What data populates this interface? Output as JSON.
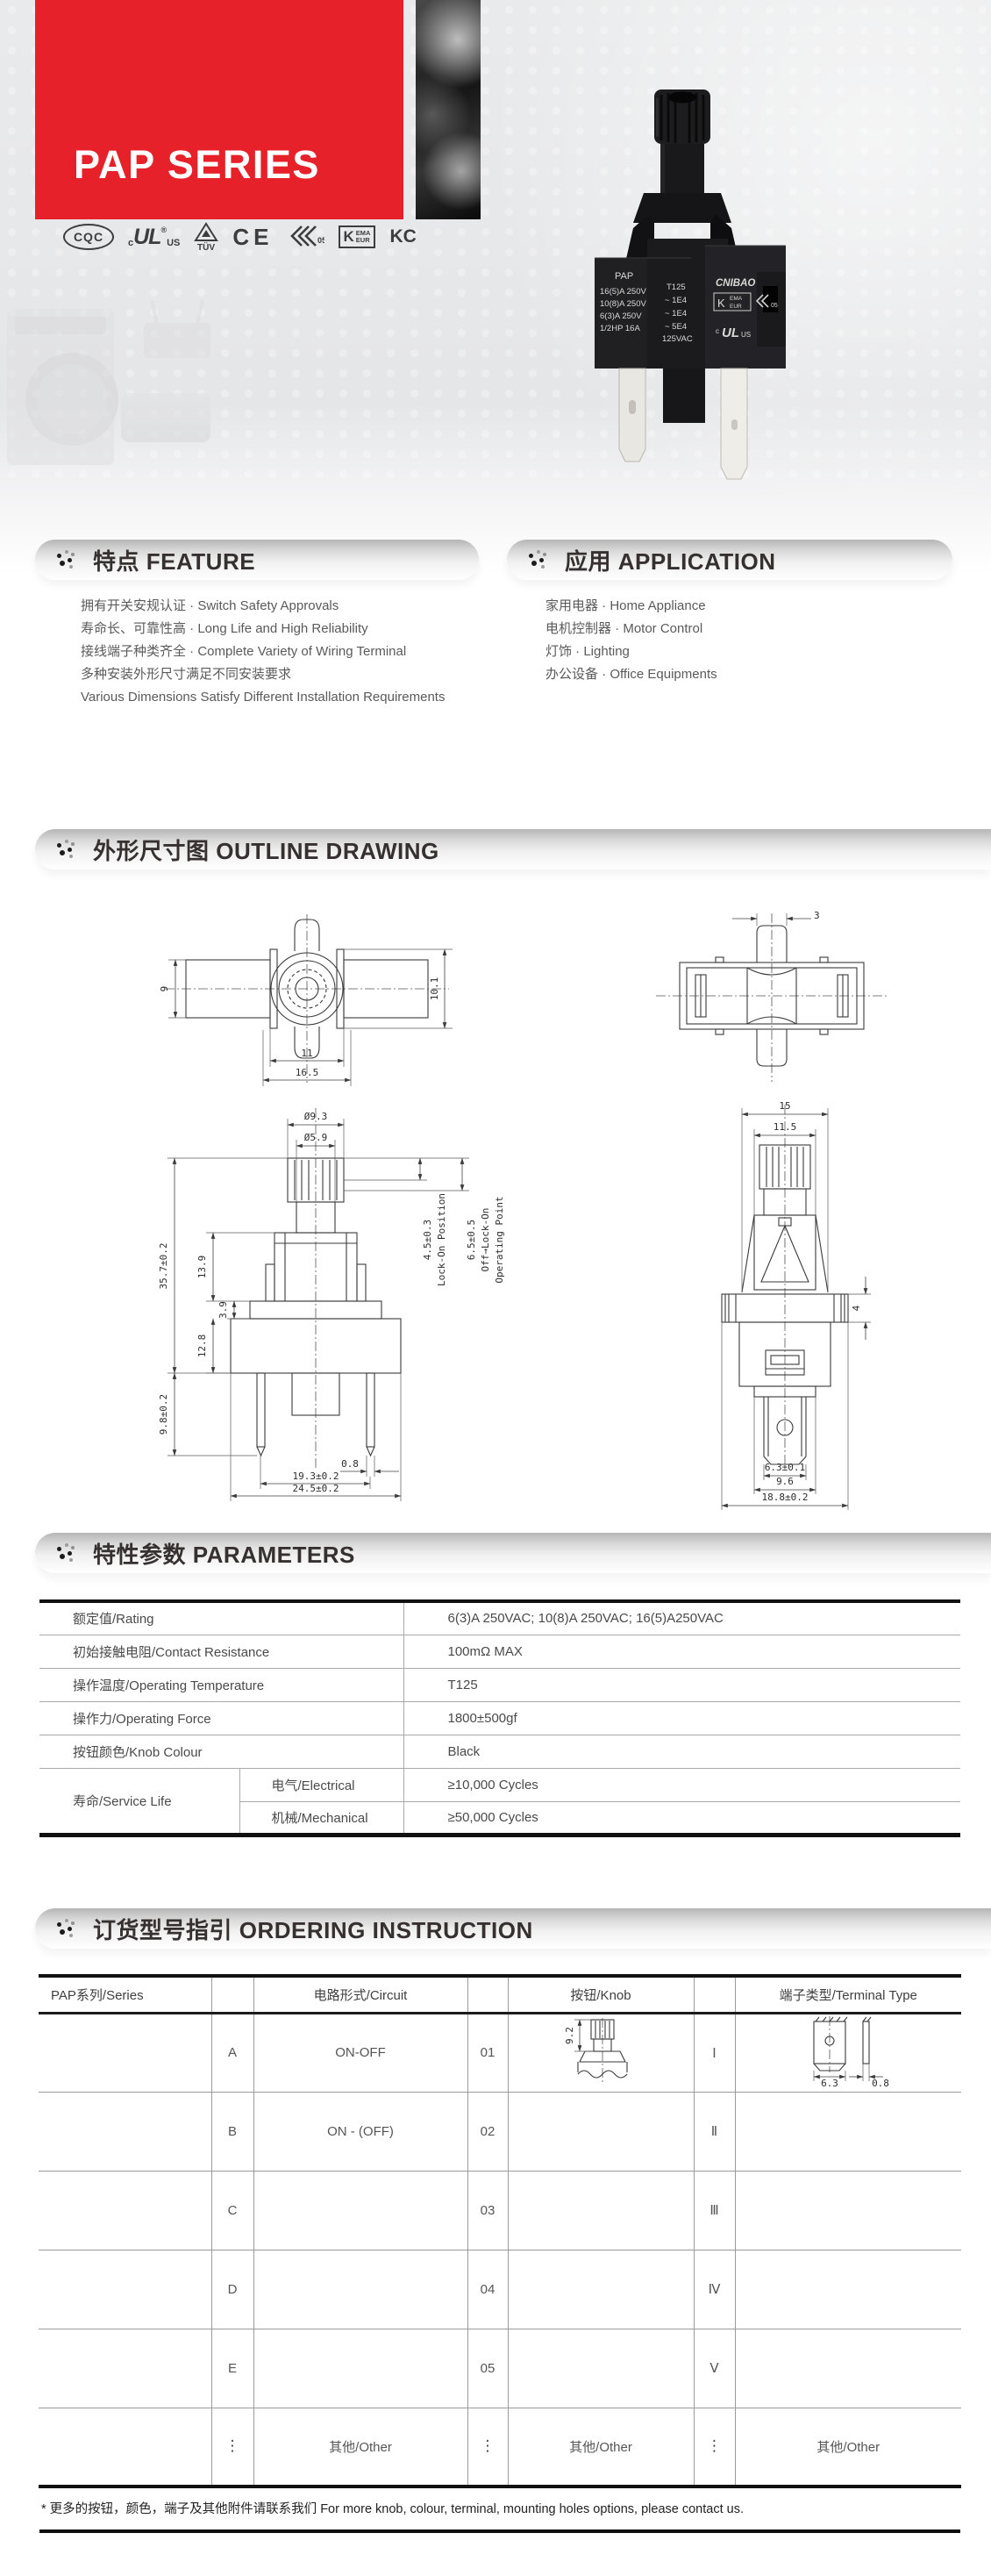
{
  "header": {
    "series_title": "PAP SERIES",
    "banner_color": "#e62129",
    "certs": {
      "cqc": "CQC",
      "ul_c": "c",
      "ul_mark": "UL",
      "ul_reg": "®",
      "ul_us": "US",
      "tuv": "TÜV",
      "ce": "CE",
      "enec_num": "05",
      "kema_k": "K",
      "kema_ema": "EMA",
      "kema_eur": "EUR",
      "kc": "KC"
    },
    "product": {
      "marking_left": [
        "PAP",
        "16(5)A 250V",
        "10(8)A 250V",
        "6(3)A  250V",
        "1/2HP 16A"
      ],
      "marking_mid": [
        "T125",
        "~ 1E4",
        "~ 1E4",
        "~ 5E4",
        "125VAC"
      ],
      "brand": "CNIBAO",
      "kema_k": "K",
      "kema_ema": "EMA",
      "kema_eur": "EUR",
      "enec_num": "05",
      "ul_c": "c",
      "ul_mark": "UL",
      "ul_us": "US"
    }
  },
  "feature": {
    "title": "特点 FEATURE",
    "items": [
      "拥有开关安规认证 · Switch Safety Approvals",
      "寿命长、可靠性高 · Long Life and High Reliability",
      "接线端子种类齐全 · Complete Variety of Wiring Terminal",
      "多种安装外形尺寸满足不同安装要求",
      "Various Dimensions Satisfy Different Installation Requirements"
    ]
  },
  "application": {
    "title": "应用 APPLICATION",
    "items": [
      "家用电器 · Home Appliance",
      "电机控制器 · Motor Control",
      "灯饰 · Lighting",
      "办公设备 · Office Equipments"
    ]
  },
  "outline": {
    "title": "外形尺寸图 OUTLINE DRAWING",
    "top_view": {
      "h_left": "9",
      "h_right": "10.1",
      "w_inner": "11",
      "w_outer": "16.5"
    },
    "bottom_view": {
      "pin_w": "3"
    },
    "front_view": {
      "knob_d": "Ø9.3",
      "shaft_d": "Ø5.9",
      "total_h": "35.7±0.2",
      "upper_h": "13.9",
      "step_h": "3.9",
      "body_h": "12.8",
      "term_l": "9.8±0.2",
      "term_t": "0.8",
      "pitch": "19.3±0.2",
      "body_w": "24.5±0.2",
      "travel1": "4.5±0.3",
      "travel1_label": "Lock-On Position",
      "travel2": "6.5±0.5",
      "travel2_label1": "Off→Lock-On",
      "travel2_label2": "Operating Point"
    },
    "side_view": {
      "w_outer": "15",
      "w_inner": "11.5",
      "flange_h": "4",
      "term_w": "6.3±0.1",
      "boss_w": "9.6",
      "base_w": "18.8±0.2"
    }
  },
  "parameters": {
    "title": "特性参数 PARAMETERS",
    "rows": [
      {
        "label": "额定值/Rating",
        "value": "6(3)A 250VAC;  10(8)A 250VAC;  16(5)A250VAC"
      },
      {
        "label": "初始接触电阻/Contact Resistance",
        "value": "100mΩ MAX"
      },
      {
        "label": "操作温度/Operating Temperature",
        "value": "T125"
      },
      {
        "label": "操作力/Operating Force",
        "value": "1800±500gf"
      },
      {
        "label": "按钮颜色/Knob Colour",
        "value": "Black"
      }
    ],
    "service_life": {
      "label": "寿命/Service Life",
      "sub_rows": [
        {
          "label": "电气/Electrical",
          "value": "≥10,000 Cycles"
        },
        {
          "label": "机械/Mechanical",
          "value": "≥50,000 Cycles"
        }
      ]
    }
  },
  "ordering": {
    "title": "订货型号指引 ORDERING INSTRUCTION",
    "col_series": "PAP系列/Series",
    "col_circuit": "电路形式/Circuit",
    "col_knob": "按钮/Knob",
    "col_terminal": "端子类型/Terminal Type",
    "rows": [
      {
        "code": "A",
        "circuit": "ON-OFF",
        "num": "01",
        "roman": "Ⅰ"
      },
      {
        "code": "B",
        "circuit": "ON - (OFF)",
        "num": "02",
        "roman": "Ⅱ"
      },
      {
        "code": "C",
        "circuit": "",
        "num": "03",
        "roman": "Ⅲ"
      },
      {
        "code": "D",
        "circuit": "",
        "num": "04",
        "roman": "Ⅳ"
      },
      {
        "code": "E",
        "circuit": "",
        "num": "05",
        "roman": "Ⅴ"
      }
    ],
    "other_row": {
      "code": "⋮",
      "circuit": "其他/Other",
      "num": "⋮",
      "knob": "其他/Other",
      "roman": "⋮",
      "terminal": "其他/Other"
    },
    "knob_dim": "9.2",
    "terminal_dim_w": "6.3",
    "terminal_dim_t": "0.8"
  },
  "footer": {
    "note": "* 更多的按钮，颜色，端子及其他附件请联系我们  For more knob, colour, terminal, mounting holes options, please contact us."
  }
}
